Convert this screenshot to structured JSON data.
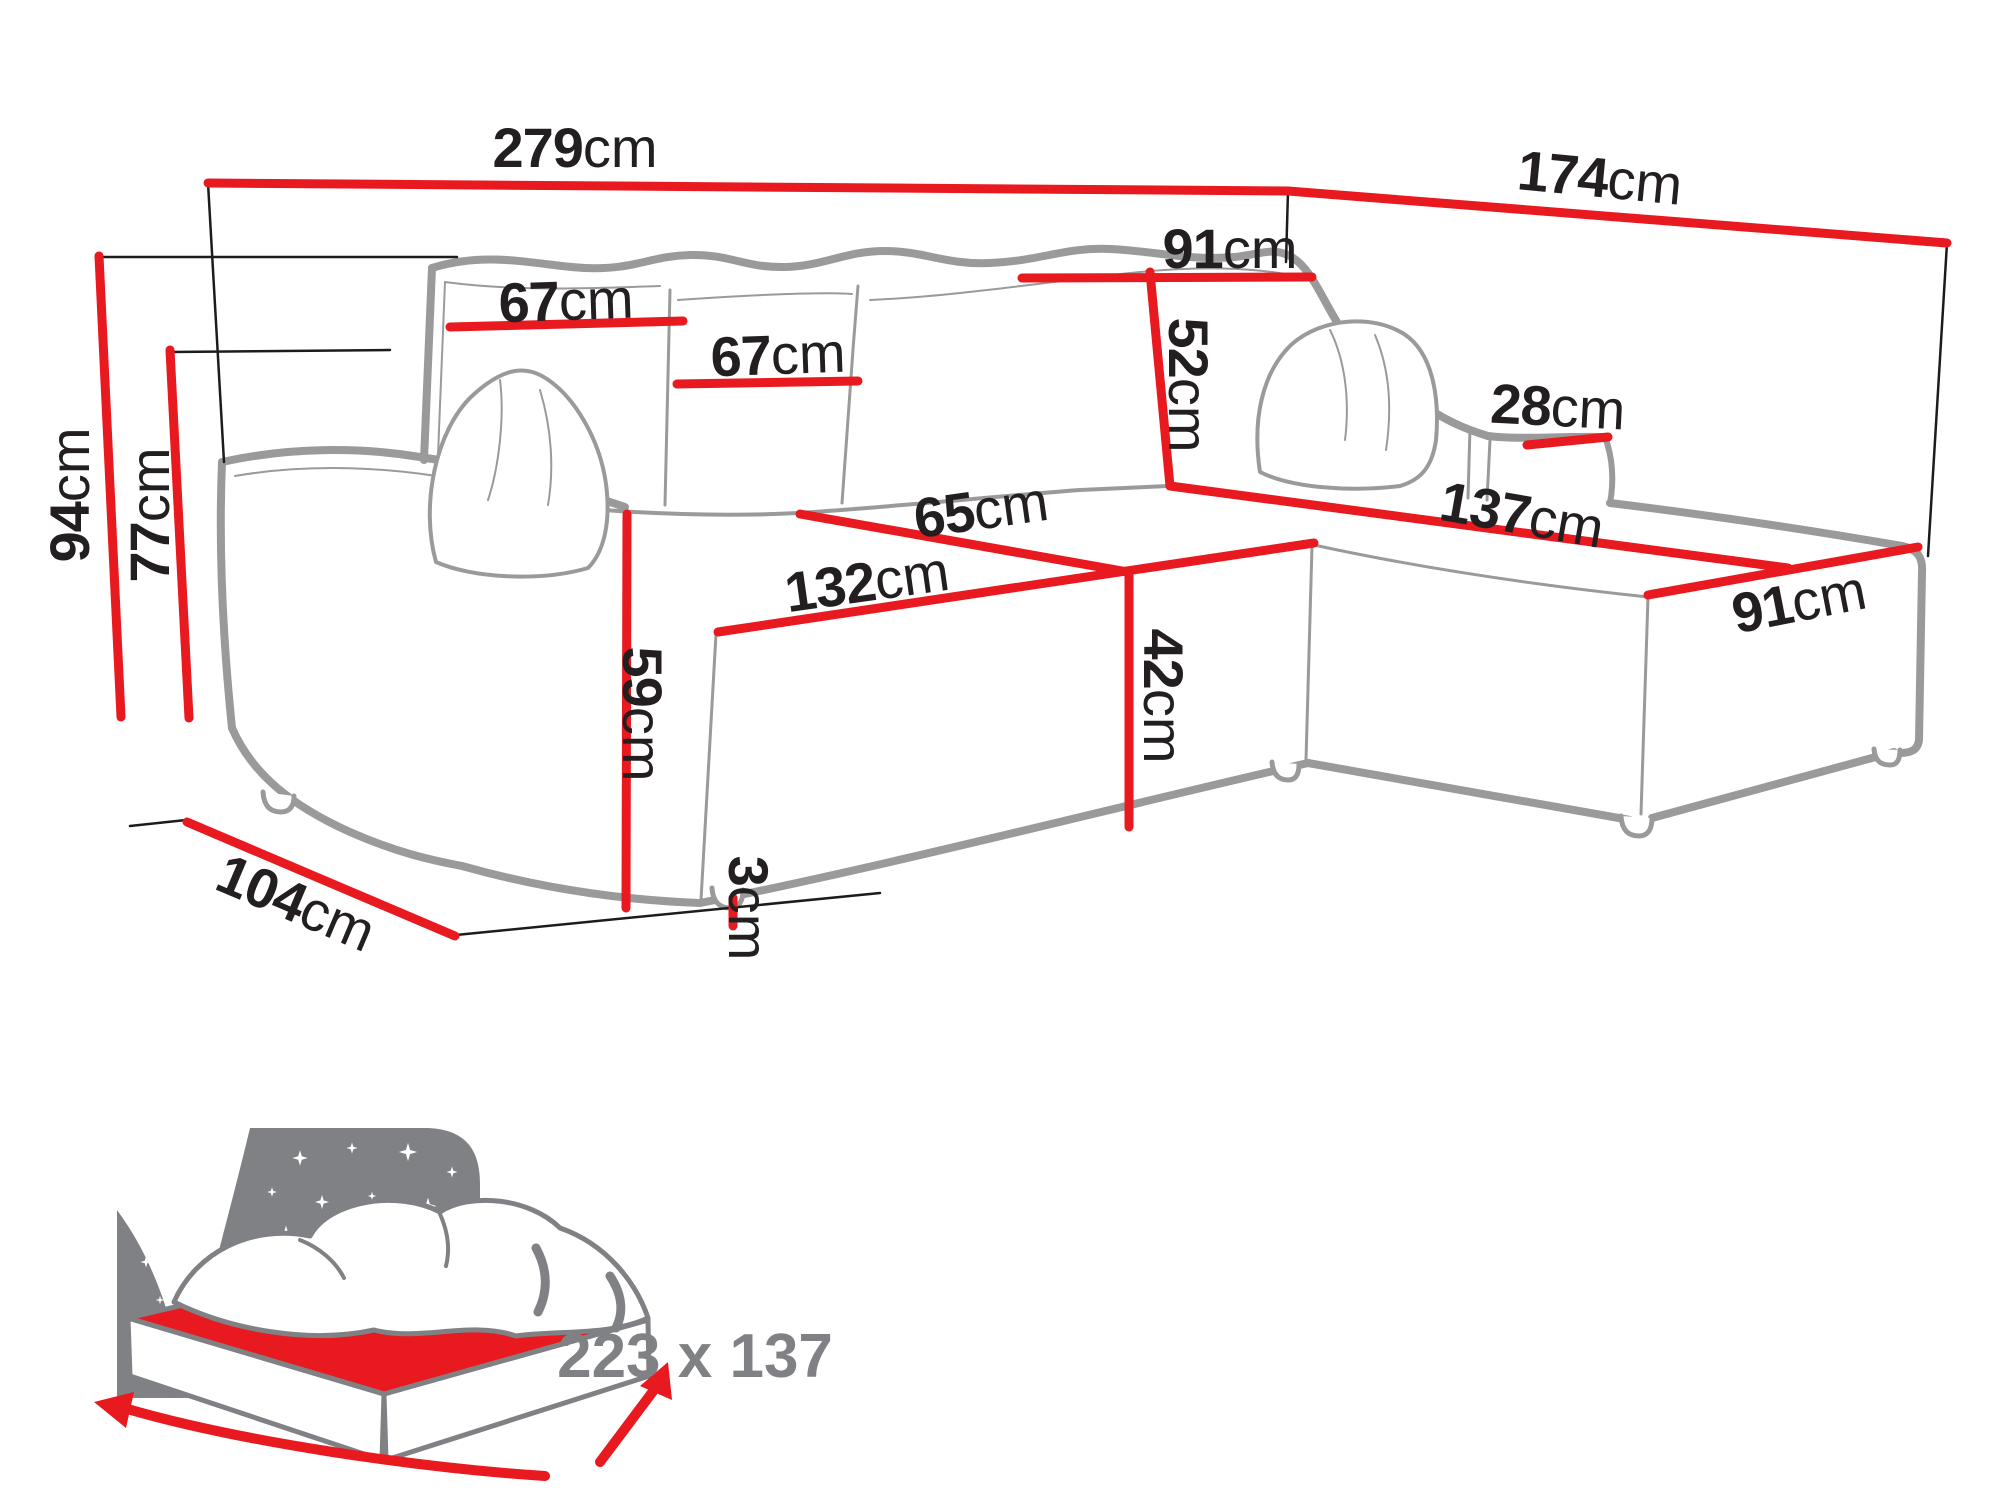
{
  "meta": {
    "description": "Corner sofa technical dimensions diagram with sleeping-area icon",
    "unit": "cm"
  },
  "colors": {
    "dimension_red": "#e8191f",
    "sofa_outline_gray": "#9a9a9a",
    "label_black": "#231f20",
    "icon_gray": "#808184"
  },
  "dims": {
    "d279": {
      "value": "279",
      "unit": "cm"
    },
    "d174": {
      "value": "174",
      "unit": "cm"
    },
    "d91top": {
      "value": "91",
      "unit": "cm"
    },
    "d67a": {
      "value": "67",
      "unit": "cm"
    },
    "d67b": {
      "value": "67",
      "unit": "cm"
    },
    "d52": {
      "value": "52",
      "unit": "cm"
    },
    "d28": {
      "value": "28",
      "unit": "cm"
    },
    "d137": {
      "value": "137",
      "unit": "cm"
    },
    "d65": {
      "value": "65",
      "unit": "cm"
    },
    "d132": {
      "value": "132",
      "unit": "cm"
    },
    "d42": {
      "value": "42",
      "unit": "cm"
    },
    "d91bot": {
      "value": "91",
      "unit": "cm"
    },
    "d94": {
      "value": "94",
      "unit": "cm"
    },
    "d77": {
      "value": "77",
      "unit": "cm"
    },
    "d59": {
      "value": "59",
      "unit": "cm"
    },
    "d3": {
      "value": "3",
      "unit": "cm"
    },
    "d104": {
      "value": "104",
      "unit": "cm"
    }
  },
  "bed": {
    "size_label": "223 x 137"
  }
}
